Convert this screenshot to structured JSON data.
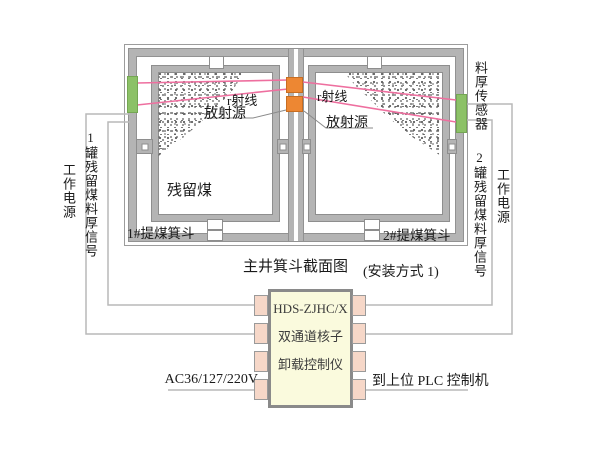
{
  "title": "主井箕斗截面图",
  "install_note": "(安装方式 1)",
  "hoppers": {
    "left": {
      "skip_label": "1#提煤箕斗",
      "coal_label": "残留煤",
      "ray_label": "r射线",
      "source_label": "放射源"
    },
    "right": {
      "skip_label": "2#提煤箕斗",
      "ray_label": "r射线",
      "source_label": "放射源"
    }
  },
  "sensor_label": "料厚传感器",
  "cables": {
    "left_power": "工作电源",
    "left_signal": "1罐残留煤料厚信号",
    "right_power": "工作电源",
    "right_signal": "2罐残留煤料厚信号"
  },
  "controller": {
    "model": "HDS-ZJHC/X",
    "line2": "双通道核子",
    "line3": "卸载控制仪",
    "power_input": "AC36/127/220V",
    "plc_output": "到上位 PLC 控制机"
  },
  "colors": {
    "sensor_green": "#8cc167",
    "source_orange": "#ed8733",
    "beam_pink": "#ee6f9f",
    "wall_gray": "#b4b4b4",
    "wire_gray": "#b9b9b9",
    "chip_fill": "#fafadd",
    "pin_fill": "#f6d7c8"
  }
}
